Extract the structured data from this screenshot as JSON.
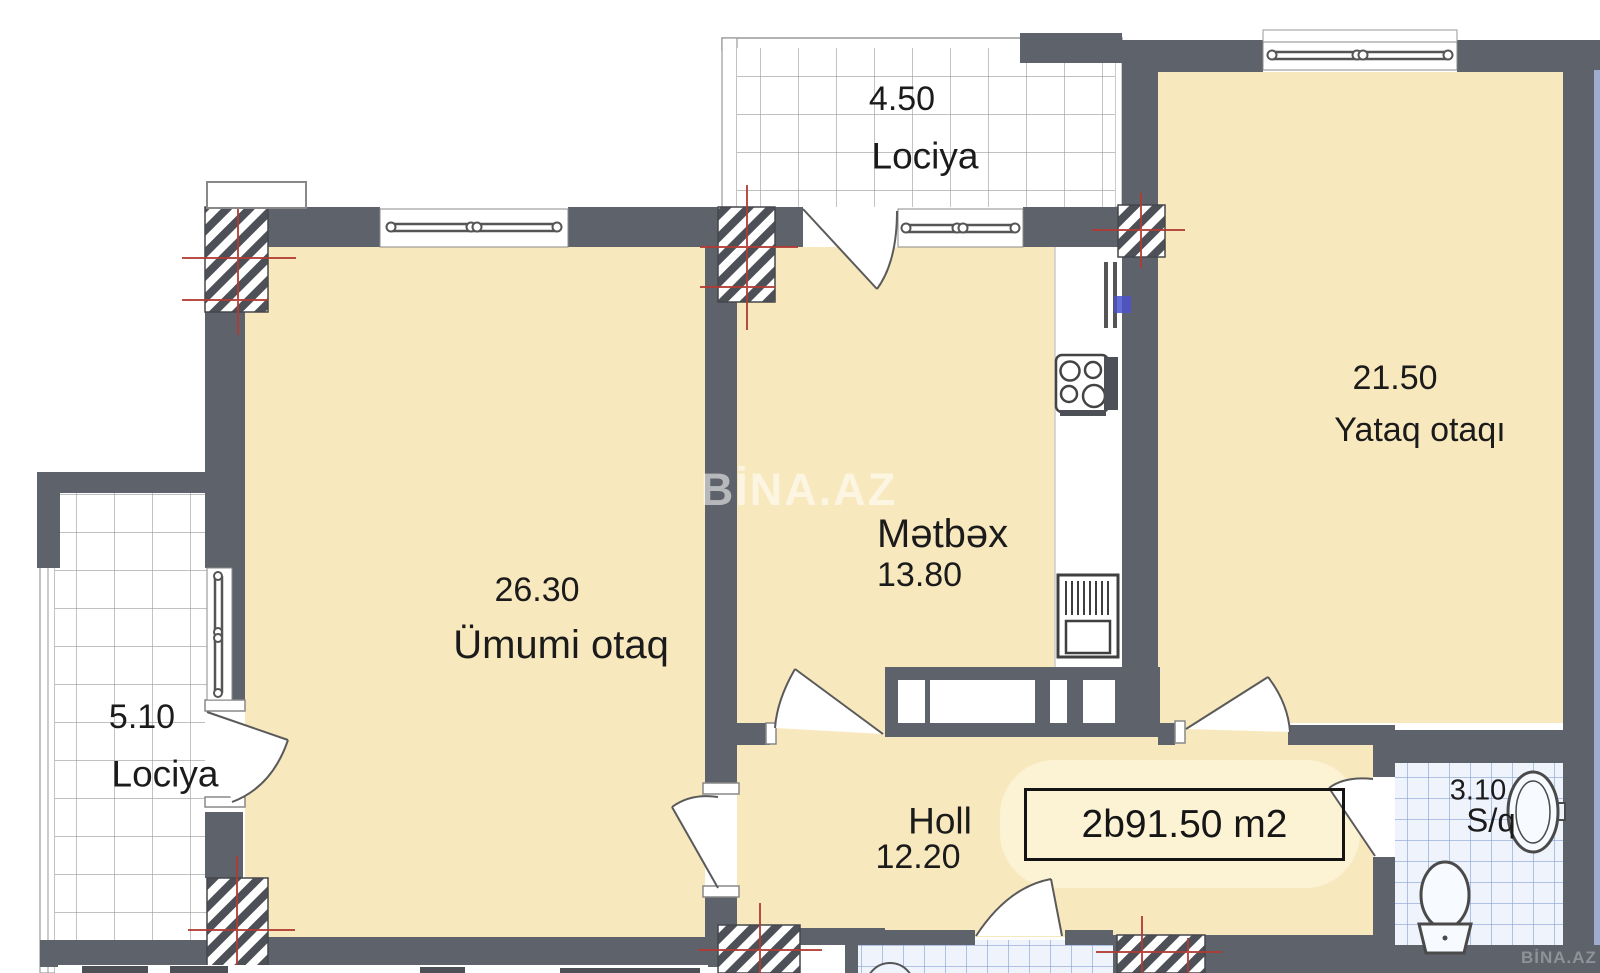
{
  "rooms": [
    {
      "id": "lociya-top",
      "name": "Lociya",
      "area": "4.50"
    },
    {
      "id": "yataq-otaqi",
      "name": "Yataq otaqı",
      "area": "21.50"
    },
    {
      "id": "metbex",
      "name": "Mətbəx",
      "area": "13.80"
    },
    {
      "id": "umumi-otaq",
      "name": "Ümumi otaq",
      "area": "26.30"
    },
    {
      "id": "lociya-left",
      "name": "Lociya",
      "area": "5.10"
    },
    {
      "id": "holl",
      "name": "Holl",
      "area": "12.20"
    },
    {
      "id": "sanqovshaq",
      "name": "S/q",
      "area": "3.10"
    }
  ],
  "total_area_label": "2b91.50 m2",
  "watermarks": {
    "center": "BİNA.AZ",
    "corner": "BİNA.AZ"
  },
  "icons": [
    "stove-icon",
    "kitchen-sink-icon",
    "toilet-icon",
    "washbasin-icon"
  ],
  "colors": {
    "wall": "#5e626a",
    "floor": "#f8e8be",
    "halo": "#fcf2d4",
    "tile_white_line": "#9b9b9b",
    "tile_blue_bg": "#eef3fc",
    "tile_blue_line": "#8aa6d6",
    "axis_red": "#b23b34",
    "wall_mark_blue": "#4a52cc"
  }
}
